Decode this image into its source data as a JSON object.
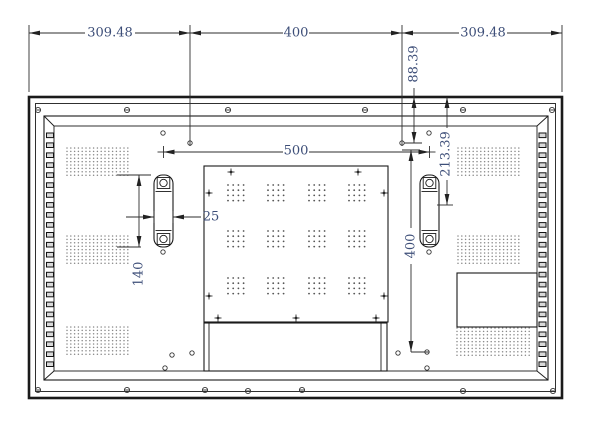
{
  "drawing": {
    "dimension_labels": {
      "top_left": "309.48",
      "top_center": "400",
      "top_right": "309.48",
      "edge_to_hole": "88.39",
      "edge_to_bracket": "213.39",
      "bracket_spacing": "500",
      "bracket_width": "25",
      "bracket_height": "140",
      "vesa_vertical": "400"
    }
  },
  "colors": {
    "dimension_text": "#3d4e78",
    "line_color": "#1a1a1a",
    "background": "#ffffff"
  }
}
